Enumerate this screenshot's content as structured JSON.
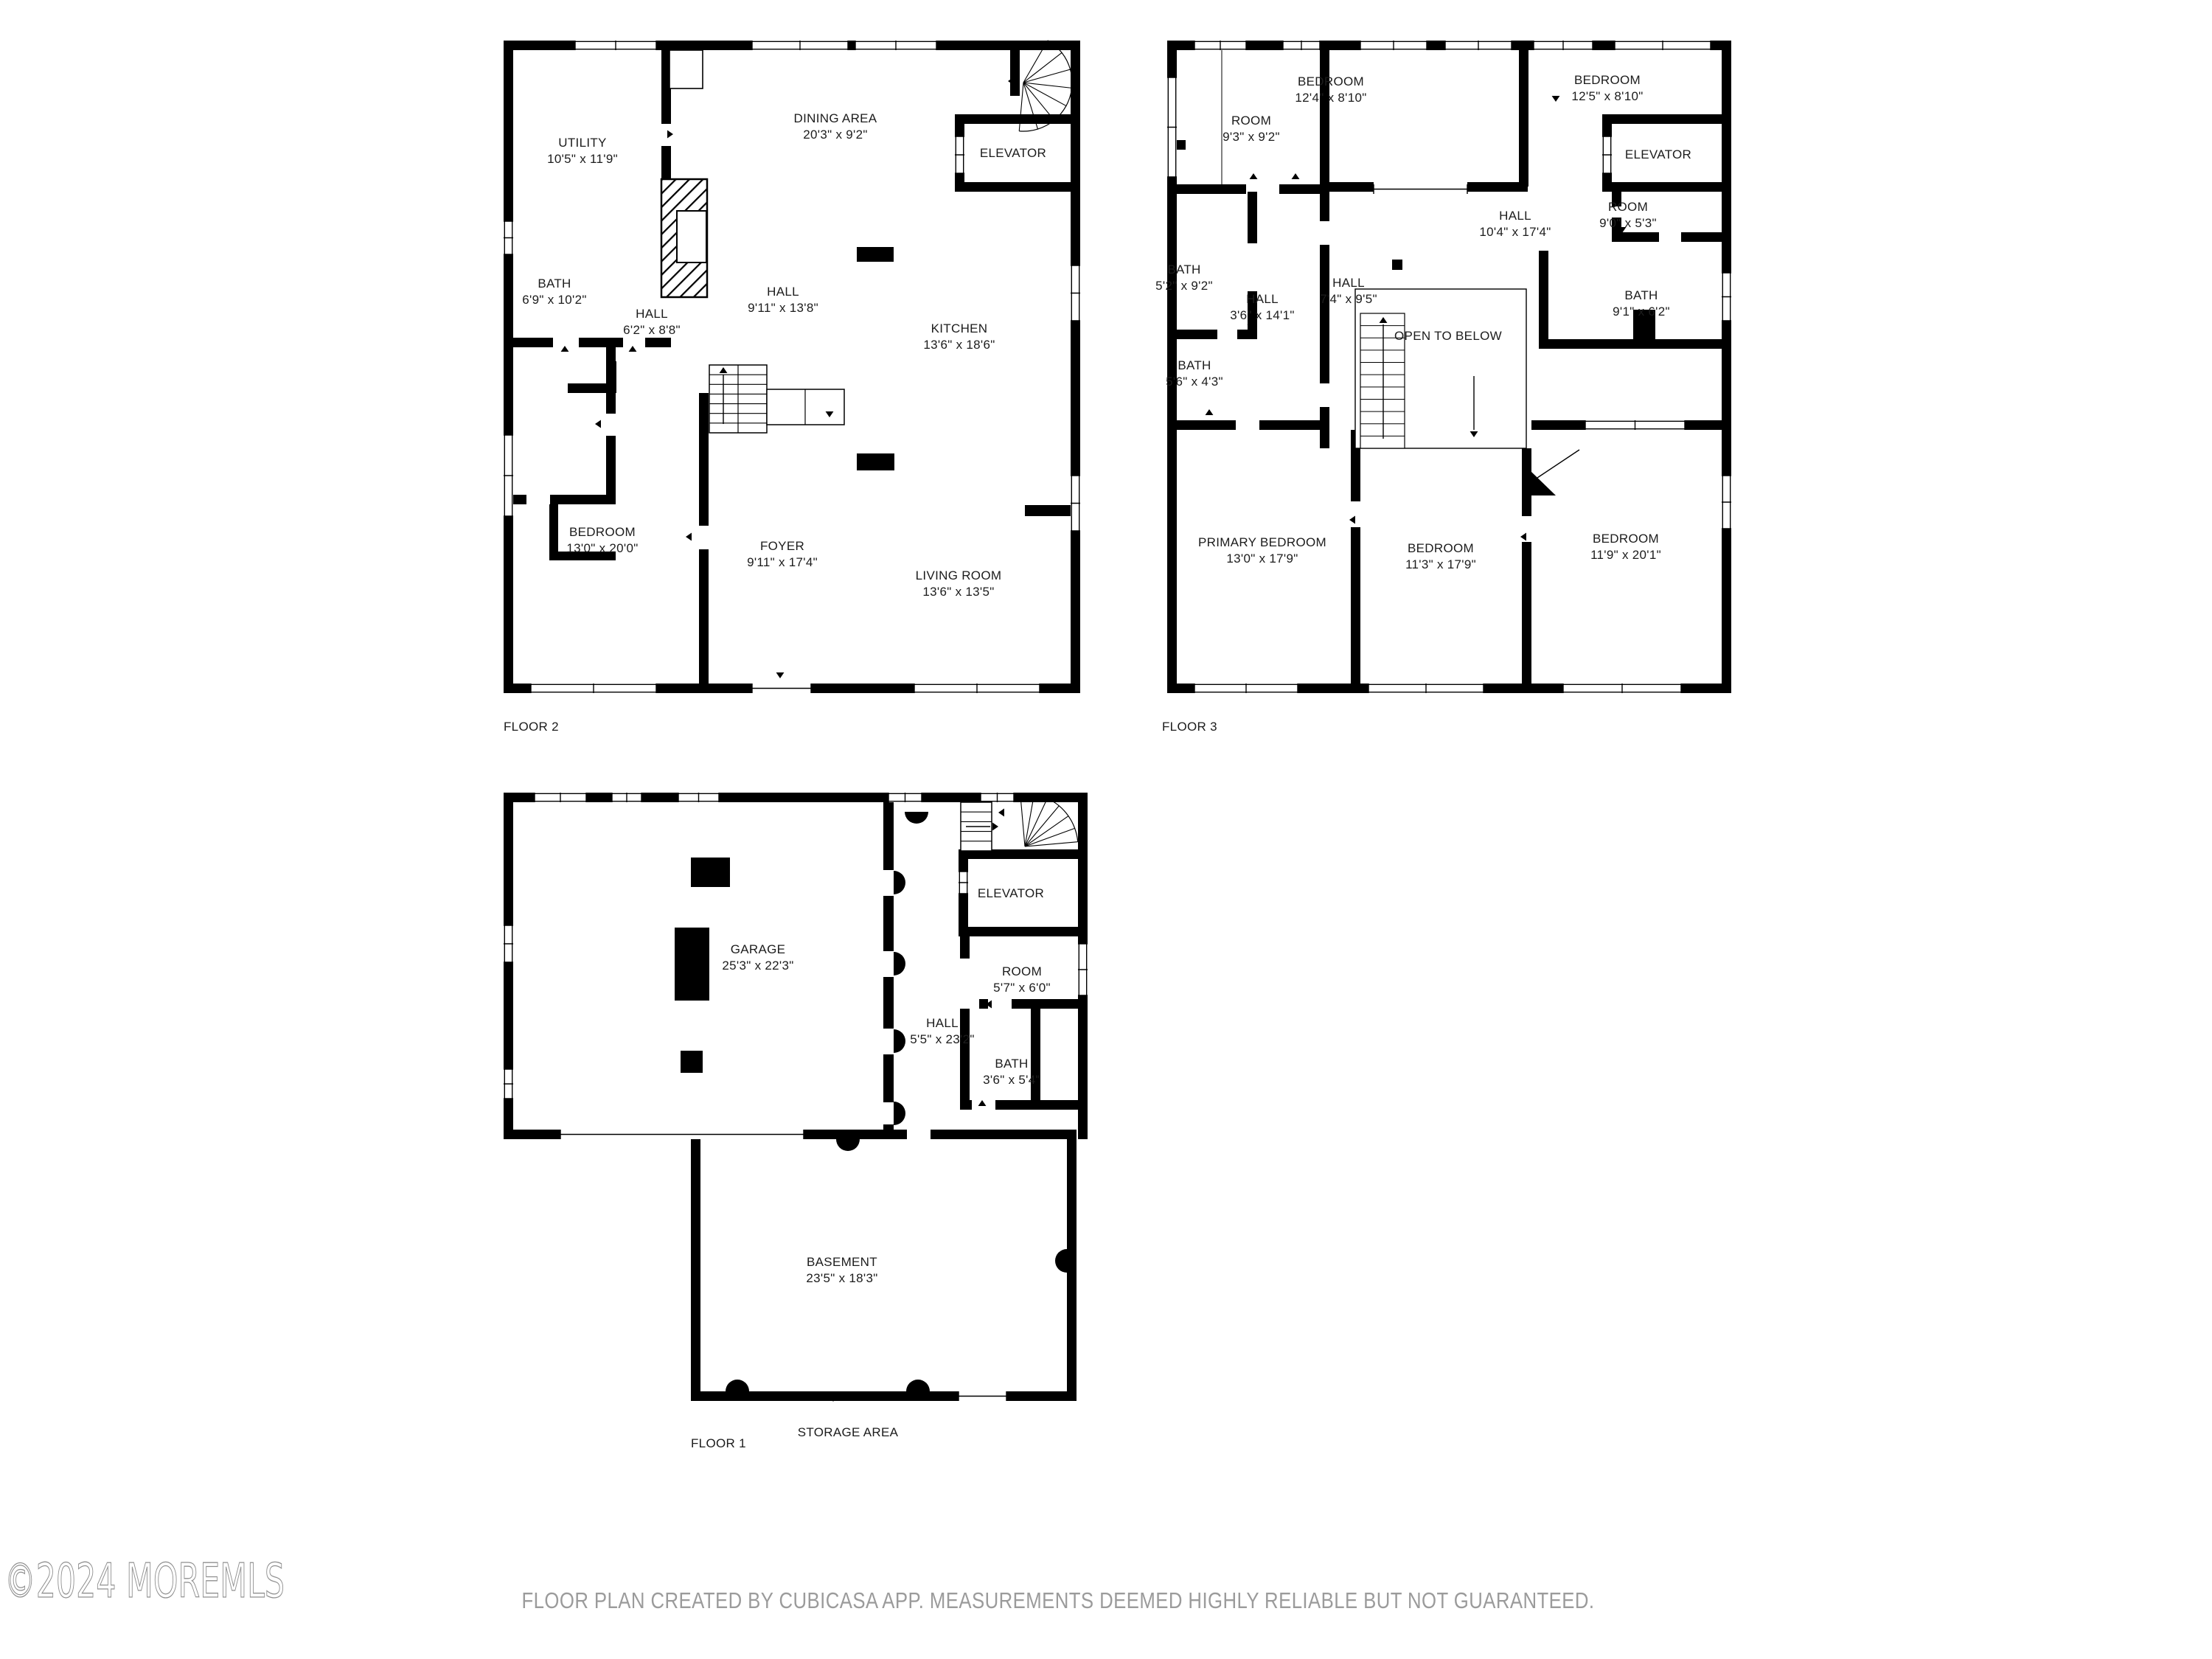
{
  "page": {
    "watermark": "©2024 MOREMLS",
    "disclaimer": "FLOOR PLAN CREATED BY CUBICASA APP. MEASUREMENTS DEEMED HIGHLY RELIABLE BUT NOT GUARANTEED."
  },
  "floor2": {
    "label": "FLOOR 2",
    "rooms": {
      "utility": {
        "name": "UTILITY",
        "dims": "10'5\" x 11'9\""
      },
      "dining": {
        "name": "DINING AREA",
        "dims": "20'3\" x 9'2\""
      },
      "elevator": {
        "name": "ELEVATOR"
      },
      "bath": {
        "name": "BATH",
        "dims": "6'9\" x 10'2\""
      },
      "hall_small": {
        "name": "HALL",
        "dims": "6'2\" x 8'8\""
      },
      "hall_main": {
        "name": "HALL",
        "dims": "9'11\" x 13'8\""
      },
      "kitchen": {
        "name": "KITCHEN",
        "dims": "13'6\" x 18'6\""
      },
      "bedroom": {
        "name": "BEDROOM",
        "dims": "13'0\" x 20'0\""
      },
      "foyer": {
        "name": "FOYER",
        "dims": "9'11\" x 17'4\""
      },
      "living": {
        "name": "LIVING ROOM",
        "dims": "13'6\" x 13'5\""
      }
    }
  },
  "floor3": {
    "label": "FLOOR 3",
    "rooms": {
      "room_small": {
        "name": "ROOM",
        "dims": "9'3\" x 9'2\""
      },
      "bedroom_mid": {
        "name": "BEDROOM",
        "dims": "12'4\" x 8'10\""
      },
      "bedroom_right": {
        "name": "BEDROOM",
        "dims": "12'5\" x 8'10\""
      },
      "elevator": {
        "name": "ELEVATOR"
      },
      "room_right": {
        "name": "ROOM",
        "dims": "9'0\" x 5'3\""
      },
      "hall_main": {
        "name": "HALL",
        "dims": "10'4\" x 17'4\""
      },
      "bath_left": {
        "name": "BATH",
        "dims": "5'2\" x 9'2\""
      },
      "hall_narrow": {
        "name": "HALL",
        "dims": "3'6\" x 14'1\""
      },
      "hall_center": {
        "name": "HALL",
        "dims": "7'4\" x 9'5\""
      },
      "open_below": {
        "name": "OPEN TO BELOW"
      },
      "bath_small": {
        "name": "BATH",
        "dims": "5'6\" x 4'3\""
      },
      "bath_right": {
        "name": "BATH",
        "dims": "9'1\" x 6'2\""
      },
      "primary": {
        "name": "PRIMARY BEDROOM",
        "dims": "13'0\" x 17'9\""
      },
      "bedroom_b": {
        "name": "BEDROOM",
        "dims": "11'3\" x 17'9\""
      },
      "bedroom_c": {
        "name": "BEDROOM",
        "dims": "11'9\" x 20'1\""
      }
    }
  },
  "floor1": {
    "label": "FLOOR 1",
    "rooms": {
      "garage": {
        "name": "GARAGE",
        "dims": "25'3\" x 22'3\""
      },
      "elevator": {
        "name": "ELEVATOR"
      },
      "room": {
        "name": "ROOM",
        "dims": "5'7\" x 6'0\""
      },
      "hall": {
        "name": "HALL",
        "dims": "5'5\" x 23'2\""
      },
      "bath": {
        "name": "BATH",
        "dims": "3'6\" x 5'4\""
      },
      "basement": {
        "name": "BASEMENT",
        "dims": "23'5\" x 18'3\""
      },
      "storage": {
        "name": "STORAGE AREA"
      }
    }
  }
}
